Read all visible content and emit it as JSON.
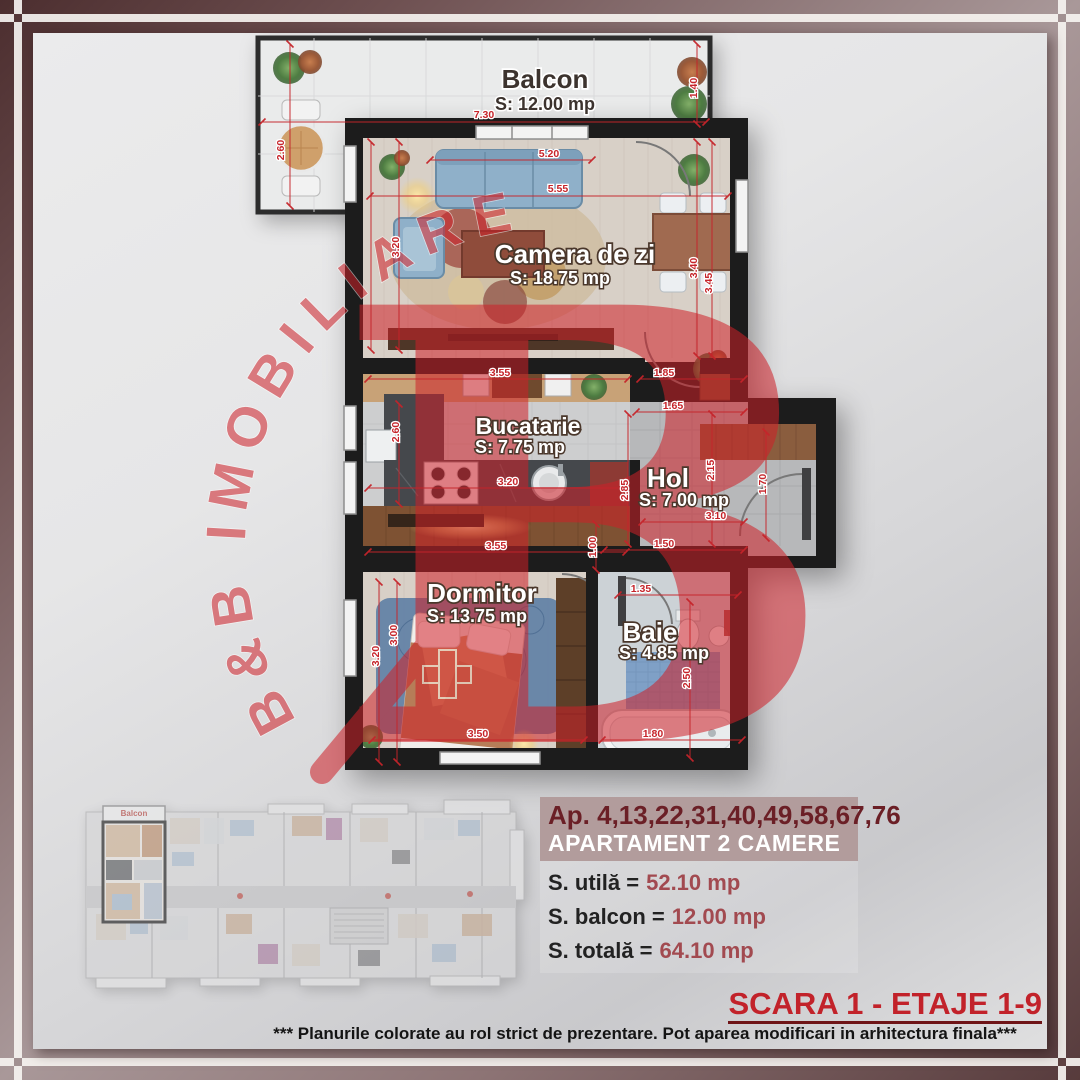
{
  "watermark": {
    "brand": "B&B  IMOBILIARE",
    "monogram": "B",
    "color": "#cf2028"
  },
  "plan": {
    "rooms": [
      {
        "name": "Balcon",
        "area": "S: 12.00 mp"
      },
      {
        "name": "Camera de zi",
        "area": "S: 18.75 mp"
      },
      {
        "name": "Bucatarie",
        "area": "S: 7.75 mp"
      },
      {
        "name": "Hol",
        "area": "S: 7.00 mp"
      },
      {
        "name": "Dormitor",
        "area": "S: 13.75 mp"
      },
      {
        "name": "Baie",
        "area": "S: 4.85 mp"
      }
    ],
    "dim_labels": [
      {
        "v": "7.30",
        "x": 484,
        "y": 118,
        "r": 0
      },
      {
        "v": "2.60",
        "x": 284,
        "y": 150,
        "r": -90
      },
      {
        "v": "1.40",
        "x": 697,
        "y": 88,
        "r": -90
      },
      {
        "v": "5.20",
        "x": 549,
        "y": 157,
        "r": 0
      },
      {
        "v": "5.55",
        "x": 558,
        "y": 192,
        "r": 0
      },
      {
        "v": "3.20",
        "x": 399,
        "y": 247,
        "r": -90
      },
      {
        "v": "3.40",
        "x": 697,
        "y": 268,
        "r": -90
      },
      {
        "v": "3.45",
        "x": 712,
        "y": 283,
        "r": -90
      },
      {
        "v": "1.85",
        "x": 664,
        "y": 376,
        "r": 0
      },
      {
        "v": "3.55",
        "x": 500,
        "y": 376,
        "r": 0
      },
      {
        "v": "2.60",
        "x": 399,
        "y": 432,
        "r": -90
      },
      {
        "v": "1.65",
        "x": 673,
        "y": 409,
        "r": 0
      },
      {
        "v": "3.20",
        "x": 508,
        "y": 485,
        "r": 0
      },
      {
        "v": "2.85",
        "x": 628,
        "y": 490,
        "r": -90
      },
      {
        "v": "2.15",
        "x": 714,
        "y": 470,
        "r": -90
      },
      {
        "v": "1.70",
        "x": 766,
        "y": 484,
        "r": -90
      },
      {
        "v": "3.10",
        "x": 716,
        "y": 519,
        "r": 0
      },
      {
        "v": "1.50",
        "x": 664,
        "y": 547,
        "r": 0
      },
      {
        "v": "1.00",
        "x": 596,
        "y": 547,
        "r": -90
      },
      {
        "v": "1.35",
        "x": 641,
        "y": 592,
        "r": 0
      },
      {
        "v": "2.50",
        "x": 690,
        "y": 678,
        "r": -90
      },
      {
        "v": "3.55",
        "x": 496,
        "y": 549,
        "r": 0
      },
      {
        "v": "3.00",
        "x": 397,
        "y": 635,
        "r": -90
      },
      {
        "v": "3.20",
        "x": 379,
        "y": 656,
        "r": -90
      },
      {
        "v": "3.50",
        "x": 478,
        "y": 737,
        "r": 0
      },
      {
        "v": "1.80",
        "x": 653,
        "y": 737,
        "r": 0
      }
    ]
  },
  "mini_plan": {
    "balcon_label": "Balcon"
  },
  "info": {
    "apartments": "Ap. 4,13,22,31,40,49,58,67,76",
    "type": "APARTAMENT 2 CAMERE",
    "areas": [
      {
        "label": "S. utilă =",
        "value": "52.10 mp"
      },
      {
        "label": "S. balcon =",
        "value": "12.00 mp"
      },
      {
        "label": "S. totală =",
        "value": "64.10 mp"
      }
    ]
  },
  "footer": {
    "scara": "SCARA 1 - ETAJE 1-9",
    "disclaimer": "*** Planurile colorate au rol strict de prezentare. Pot aparea modificari in arhitectura finala***"
  },
  "colors": {
    "accent_red": "#c6242a",
    "frame_dark": "#4c2e2f",
    "frame_light": "#a99899",
    "title_maroon": "#6b1f26",
    "value_red": "#a24a50",
    "wall_black": "#1c1c1c"
  }
}
